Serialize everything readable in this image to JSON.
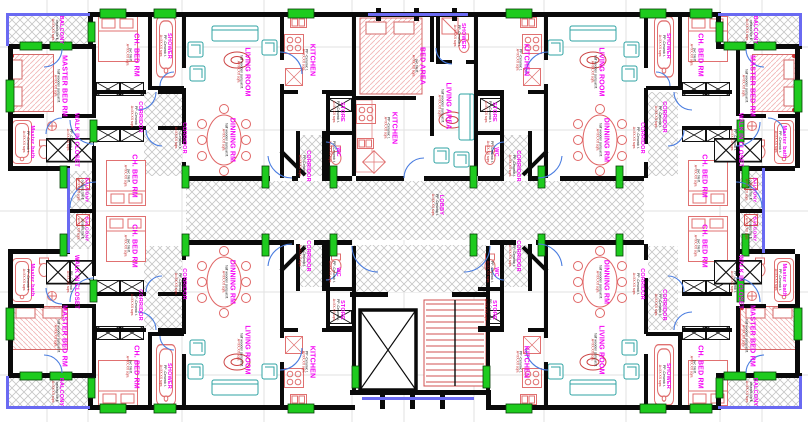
{
  "colors": {
    "wall_black": "#0a0a0a",
    "label_magenta": "#f400f4",
    "furniture_red": "#e07070",
    "dining_red": "#e06666",
    "sofa_teal": "#2fa3a3",
    "window_green": "#1ecb1e",
    "glazing_blue": "#6a6af2",
    "door_arc_blue": "#4a7de0",
    "hatch_gray": "#c6c6c6",
    "stair_red": "#d05050",
    "area_text_red": "#c22020",
    "grid_gray": "#e2e2e2"
  },
  "floor_specs": {
    "parq": "half wooden parquet fl.",
    "tile": "pvc tile fl.",
    "cer": "PP -Ceramic t.",
    "bal": "ceramic tile fl.",
    "area": "A=XX.XX sqm."
  },
  "rooms": [
    {
      "t": "BALCONY",
      "x": 57,
      "y": 30,
      "c": "sm",
      "f": "bal"
    },
    {
      "t": "MASTER BED RM",
      "x": 60,
      "y": 86,
      "c": "lg",
      "f": "parq"
    },
    {
      "t": "Master bath",
      "x": 28,
      "y": 142,
      "c": "sm",
      "f": "cer"
    },
    {
      "t": "WALK IN CLOSET",
      "x": 72,
      "y": 140,
      "c": "md",
      "f": "cer"
    },
    {
      "t": "CH. BED RM",
      "x": 132,
      "y": 55,
      "c": "lg",
      "f": "tile"
    },
    {
      "t": "SHOWER",
      "x": 165,
      "y": 46,
      "c": "sm",
      "f": "cer"
    },
    {
      "t": "CORRIDOR",
      "x": 136,
      "y": 117,
      "c": "sm",
      "f": "cer"
    },
    {
      "t": "CORRIDOR",
      "x": 180,
      "y": 138,
      "c": "sm",
      "f": "cer"
    },
    {
      "t": "LIVING ROOM",
      "x": 243,
      "y": 72,
      "c": "lg",
      "f": "parq"
    },
    {
      "t": "DINNING RM",
      "x": 228,
      "y": 140,
      "c": "lg",
      "f": "parq"
    },
    {
      "t": "KITCHEN",
      "x": 308,
      "y": 60,
      "c": "lg",
      "f": "cer"
    },
    {
      "t": "STORE",
      "x": 338,
      "y": 112,
      "c": "sm",
      "f": "cer"
    },
    {
      "t": "WC",
      "x": 334,
      "y": 152,
      "c": "sm",
      "f": "cer"
    },
    {
      "t": "CORRIDOR",
      "x": 304,
      "y": 166,
      "c": "sm",
      "f": "cer"
    },
    {
      "t": "BED AREA",
      "x": 418,
      "y": 66,
      "c": "lg",
      "f": "tile"
    },
    {
      "t": "SHOWER",
      "x": 459,
      "y": 36,
      "c": "sm",
      "f": "cer"
    },
    {
      "t": "LIVING AREA",
      "x": 444,
      "y": 106,
      "c": "lg",
      "f": "parq"
    },
    {
      "t": "KITCHEN",
      "x": 390,
      "y": 128,
      "c": "lg",
      "f": "cer"
    },
    {
      "t": "BALCONY",
      "x": 751,
      "y": 30,
      "c": "sm",
      "f": "bal"
    },
    {
      "t": "MASTER BED RM",
      "x": 748,
      "y": 86,
      "c": "lg",
      "f": "parq"
    },
    {
      "t": "Master bath",
      "x": 780,
      "y": 142,
      "c": "sm",
      "f": "cer"
    },
    {
      "t": "WALK IN CLOSET",
      "x": 736,
      "y": 140,
      "c": "md",
      "f": "cer"
    },
    {
      "t": "CH. BED RM",
      "x": 696,
      "y": 55,
      "c": "lg",
      "f": "tile"
    },
    {
      "t": "SHOWER",
      "x": 664,
      "y": 46,
      "c": "sm",
      "f": "cer"
    },
    {
      "t": "CORRIDOR",
      "x": 660,
      "y": 117,
      "c": "sm",
      "f": "cer"
    },
    {
      "t": "CORRIDOR",
      "x": 638,
      "y": 138,
      "c": "sm",
      "f": "cer"
    },
    {
      "t": "LIVING ROOM",
      "x": 597,
      "y": 72,
      "c": "lg",
      "f": "parq"
    },
    {
      "t": "DINNING RM",
      "x": 602,
      "y": 140,
      "c": "lg",
      "f": "parq"
    },
    {
      "t": "KITCHEN",
      "x": 522,
      "y": 60,
      "c": "lg",
      "f": "cer"
    },
    {
      "t": "STORE",
      "x": 490,
      "y": 112,
      "c": "sm",
      "f": "cer"
    },
    {
      "t": "WC",
      "x": 492,
      "y": 152,
      "c": "sm",
      "f": "cer"
    },
    {
      "t": "CORRIDOR",
      "x": 514,
      "y": 166,
      "c": "sm",
      "f": "cer"
    },
    {
      "t": "LOBBY",
      "x": 437,
      "y": 205,
      "c": "sm",
      "f": "cer"
    },
    {
      "t": "BALCONY",
      "x": 82,
      "y": 190,
      "c": "xs",
      "f": "bal"
    },
    {
      "t": "BALCONY",
      "x": 82,
      "y": 229,
      "c": "xs",
      "f": "bal"
    },
    {
      "t": "BALCONY",
      "x": 750,
      "y": 190,
      "c": "xs",
      "f": "bal"
    },
    {
      "t": "BALCONY",
      "x": 750,
      "y": 229,
      "c": "xs",
      "f": "bal"
    },
    {
      "t": "CH. BED RM",
      "x": 130,
      "y": 176,
      "c": "lg",
      "f": "tile"
    },
    {
      "t": "CH. BED RM",
      "x": 700,
      "y": 176,
      "c": "lg",
      "f": "tile"
    },
    {
      "t": "CH. BED RM",
      "x": 130,
      "y": 246,
      "c": "lg",
      "f": "tile"
    },
    {
      "t": "CH. BED RM",
      "x": 700,
      "y": 246,
      "c": "lg",
      "f": "tile"
    },
    {
      "t": "BALCONY",
      "x": 57,
      "y": 392,
      "c": "sm",
      "f": "bal"
    },
    {
      "t": "MASTER BED RM",
      "x": 60,
      "y": 336,
      "c": "lg",
      "f": "parq"
    },
    {
      "t": "Master bath",
      "x": 28,
      "y": 280,
      "c": "sm",
      "f": "cer"
    },
    {
      "t": "WALK IN CLOSET",
      "x": 72,
      "y": 282,
      "c": "md",
      "f": "cer"
    },
    {
      "t": "CH. BED RM",
      "x": 132,
      "y": 367,
      "c": "lg",
      "f": "tile"
    },
    {
      "t": "SHOWER",
      "x": 165,
      "y": 376,
      "c": "sm",
      "f": "cer"
    },
    {
      "t": "CORRIDOR",
      "x": 136,
      "y": 305,
      "c": "sm",
      "f": "cer"
    },
    {
      "t": "CORRIDOR",
      "x": 180,
      "y": 284,
      "c": "sm",
      "f": "cer"
    },
    {
      "t": "LIVING ROOM",
      "x": 243,
      "y": 350,
      "c": "lg",
      "f": "parq"
    },
    {
      "t": "DINNING RM",
      "x": 228,
      "y": 282,
      "c": "lg",
      "f": "parq"
    },
    {
      "t": "KITCHEN",
      "x": 308,
      "y": 362,
      "c": "lg",
      "f": "cer"
    },
    {
      "t": "STORE",
      "x": 338,
      "y": 310,
      "c": "sm",
      "f": "cer"
    },
    {
      "t": "WC",
      "x": 334,
      "y": 272,
      "c": "sm",
      "f": "cer"
    },
    {
      "t": "CORRIDOR",
      "x": 304,
      "y": 256,
      "c": "sm",
      "f": "cer"
    },
    {
      "t": "BALCONY",
      "x": 751,
      "y": 392,
      "c": "sm",
      "f": "bal"
    },
    {
      "t": "MASTER BED RM",
      "x": 748,
      "y": 336,
      "c": "lg",
      "f": "parq"
    },
    {
      "t": "Master bath",
      "x": 780,
      "y": 280,
      "c": "sm",
      "f": "cer"
    },
    {
      "t": "WALK IN CLOSET",
      "x": 736,
      "y": 282,
      "c": "md",
      "f": "cer"
    },
    {
      "t": "CH. BED RM",
      "x": 696,
      "y": 367,
      "c": "lg",
      "f": "tile"
    },
    {
      "t": "SHOWER",
      "x": 664,
      "y": 376,
      "c": "sm",
      "f": "cer"
    },
    {
      "t": "CORRIDOR",
      "x": 660,
      "y": 305,
      "c": "sm",
      "f": "cer"
    },
    {
      "t": "CORRIDOR",
      "x": 638,
      "y": 284,
      "c": "sm",
      "f": "cer"
    },
    {
      "t": "LIVING ROOM",
      "x": 597,
      "y": 350,
      "c": "lg",
      "f": "parq"
    },
    {
      "t": "DINNING RM",
      "x": 602,
      "y": 282,
      "c": "lg",
      "f": "parq"
    },
    {
      "t": "KITCHEN",
      "x": 522,
      "y": 362,
      "c": "lg",
      "f": "cer"
    },
    {
      "t": "STORE",
      "x": 490,
      "y": 310,
      "c": "sm",
      "f": "cer"
    },
    {
      "t": "WC",
      "x": 492,
      "y": 272,
      "c": "sm",
      "f": "cer"
    },
    {
      "t": "CORRIDOR",
      "x": 514,
      "y": 256,
      "c": "sm",
      "f": "cer"
    }
  ]
}
